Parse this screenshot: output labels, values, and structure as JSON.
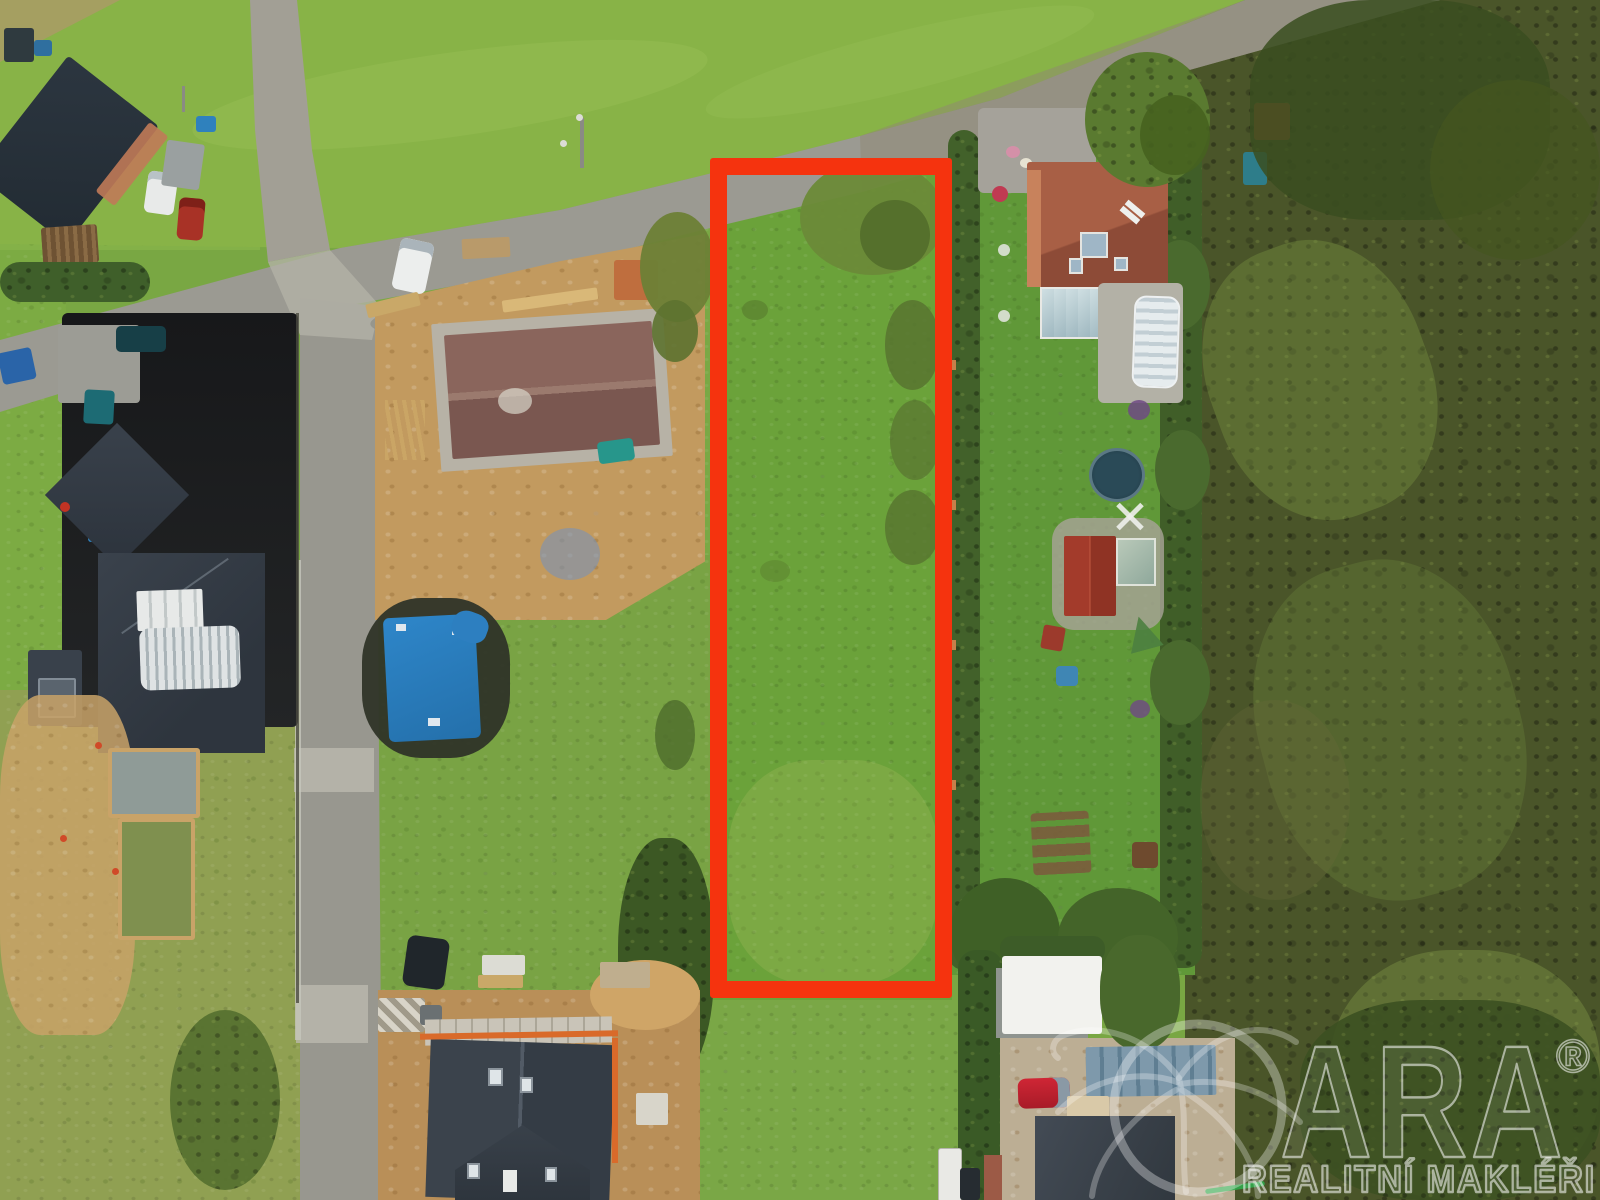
{
  "meta": {
    "description": "Aerial drone photograph of a rural building plot for sale, highlighted with a red boundary rectangle, surrounded by family houses, houses under construction, roads, gardens and fields"
  },
  "watermark": {
    "brand": "QARA",
    "registered_symbol": "®",
    "tagline": "REALITNÍ MAKLÉŘI"
  },
  "colors": {
    "highlight_outline": "#f5330e",
    "watermark": "rgba(255,255,255,0.55)",
    "grass_light": "#88b347",
    "grass_mid": "#6ba23a",
    "field_dark": "#4a5529",
    "road_asphalt": "#9b9a92",
    "dirt": "#c29a5f",
    "roof_dark": "#343c46",
    "roof_terracotta": "#9d5740",
    "roof_construction": "#82605a",
    "tarp_blue": "#2e86c9"
  }
}
